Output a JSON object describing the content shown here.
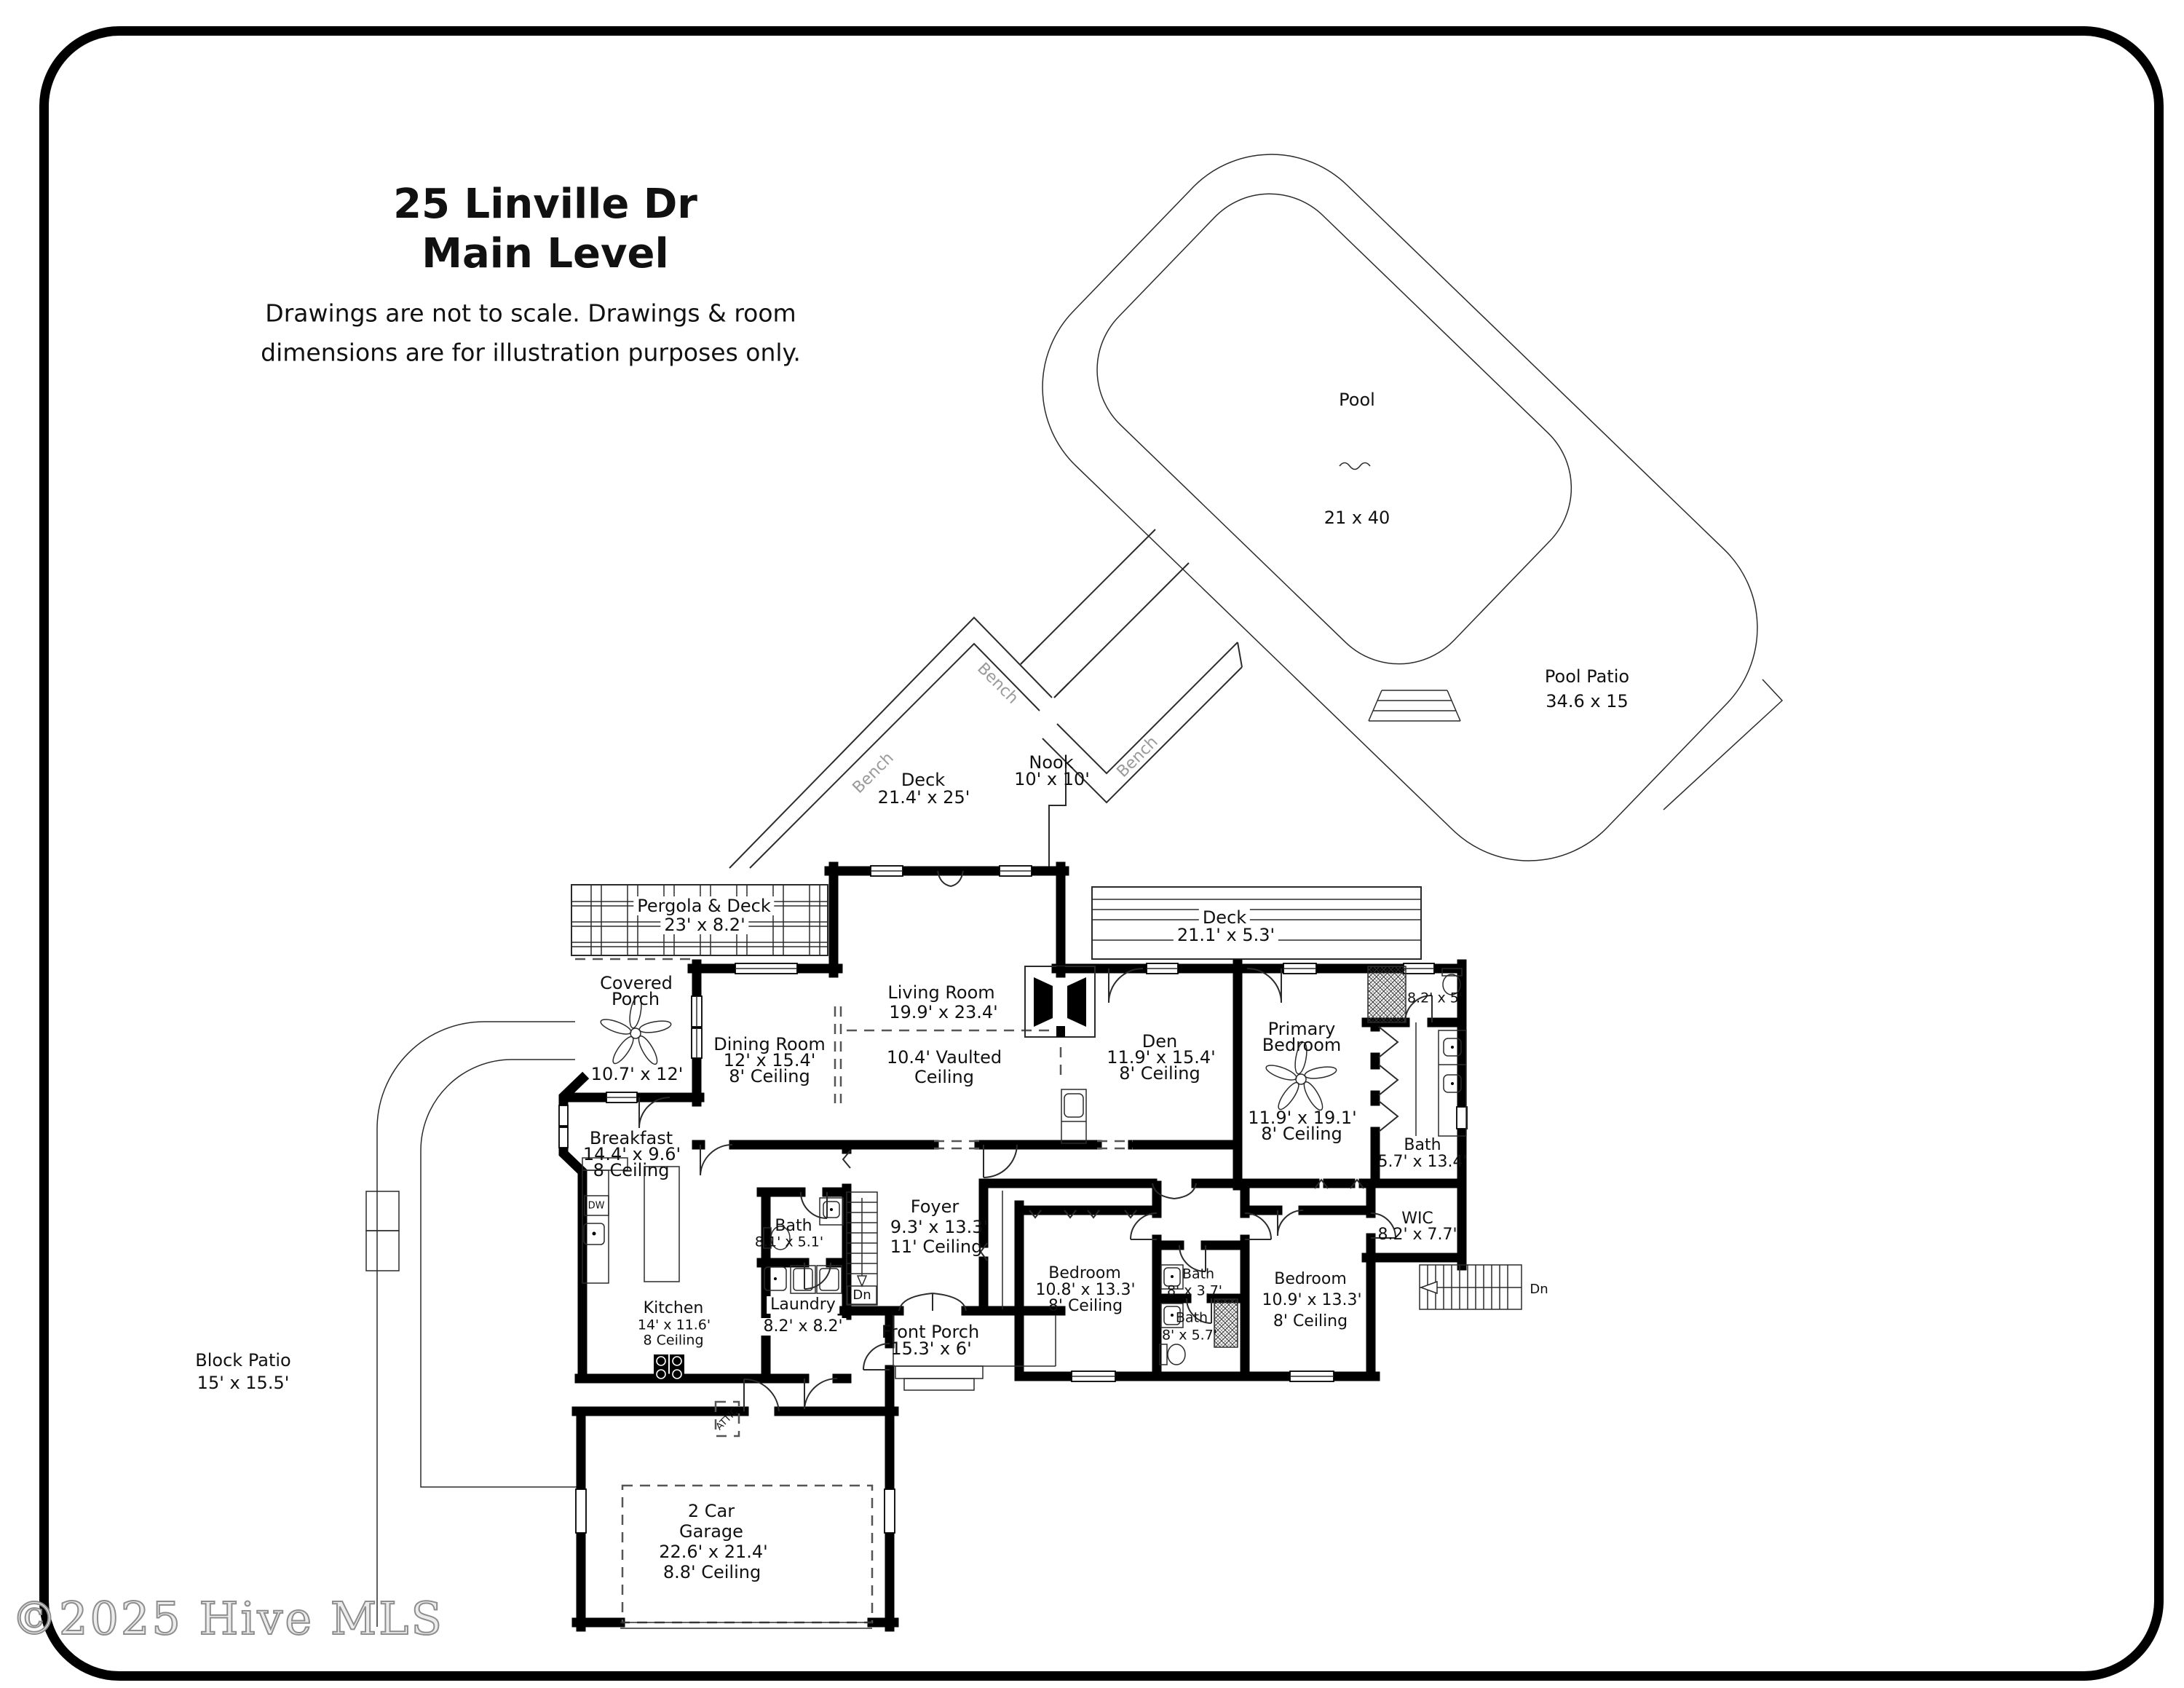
{
  "colors": {
    "wall": "#000000",
    "line": "#2b2b2b",
    "dashed": "#555555",
    "label": "#111111",
    "bench": "#9a9a9a",
    "watermark_stroke": "#8e8e8e",
    "background": "#ffffff"
  },
  "title": {
    "line1": "25 Linville Dr",
    "line2": "Main Level"
  },
  "disclaimer": {
    "line1": "Drawings are not to scale. Drawings & room",
    "line2": "dimensions are for illustration purposes only."
  },
  "watermark": "©2025 Hive MLS",
  "rooms": {
    "pool": {
      "name": "Pool",
      "dims": "21 x 40"
    },
    "pool_patio": {
      "name": "Pool Patio",
      "dims": "34.6 x 15"
    },
    "deck_main": {
      "name": "Deck",
      "dims": "21.4' x 25'"
    },
    "nook": {
      "name": "Nook",
      "dims": "10' x 10'"
    },
    "pergola": {
      "name": "Pergola & Deck",
      "dims": "23' x 8.2'"
    },
    "covered_porch": {
      "name1": "Covered",
      "name2": "Porch",
      "dims": "10.7' x 12'"
    },
    "dining": {
      "name": "Dining Room",
      "dims": "12' x 15.4'",
      "ceiling": "8' Ceiling"
    },
    "living": {
      "name": "Living Room",
      "dims": "19.9' x 23.4'",
      "vault1": "10.4' Vaulted",
      "vault2": "Ceiling"
    },
    "deck_right": {
      "name": "Deck",
      "dims": "21.1' x 5.3'"
    },
    "den": {
      "name": "Den",
      "dims": "11.9' x 15.4'",
      "ceiling": "8' Ceiling"
    },
    "primary": {
      "name1": "Primary",
      "name2": "Bedroom",
      "dims": "11.9' x 19.1'",
      "ceiling": "8' Ceiling"
    },
    "wc": {
      "dims": "8.2' x 5'"
    },
    "bath_primary": {
      "name": "Bath",
      "dims": "5.7' x 13.4'"
    },
    "wic": {
      "name": "WIC",
      "dims": "8.2' x 7.7'"
    },
    "breakfast": {
      "name": "Breakfast",
      "dims": "14.4' x 9.6'",
      "ceiling": "8 Ceiling"
    },
    "kitchen": {
      "name": "Kitchen",
      "dims": "14' x 11.6'",
      "ceiling": "8 Ceiling"
    },
    "bath_hall": {
      "name": "Bath",
      "dims": "8.1' x 5.1'"
    },
    "laundry": {
      "name": "Laundry",
      "dims": "8.2' x 8.2'"
    },
    "foyer": {
      "name": "Foyer",
      "dims": "9.3' x 13.3'",
      "ceiling": "11' Ceiling"
    },
    "front_porch": {
      "name": "Front Porch",
      "dims": "15.3' x 6'"
    },
    "bedroom1": {
      "name": "Bedroom",
      "dims": "10.8' x 13.3'",
      "ceiling": "8' Ceiling"
    },
    "bath1": {
      "name": "Bath",
      "dims": "8' x 3.7'"
    },
    "bath2": {
      "name": "Bath",
      "dims": "8' x 5.7'"
    },
    "bedroom2": {
      "name": "Bedroom",
      "dims": "10.9' x 13.3'",
      "ceiling": "8' Ceiling"
    },
    "garage": {
      "name1": "2 Car",
      "name2": "Garage",
      "dims": "22.6' x 21.4'",
      "ceiling": "8.8' Ceiling"
    },
    "block_patio": {
      "name": "Block Patio",
      "dims": "15' x 15.5'"
    }
  },
  "annotations": {
    "bench": "Bench",
    "dn": "Dn",
    "dw": "DW",
    "attic": "ATTIC"
  }
}
